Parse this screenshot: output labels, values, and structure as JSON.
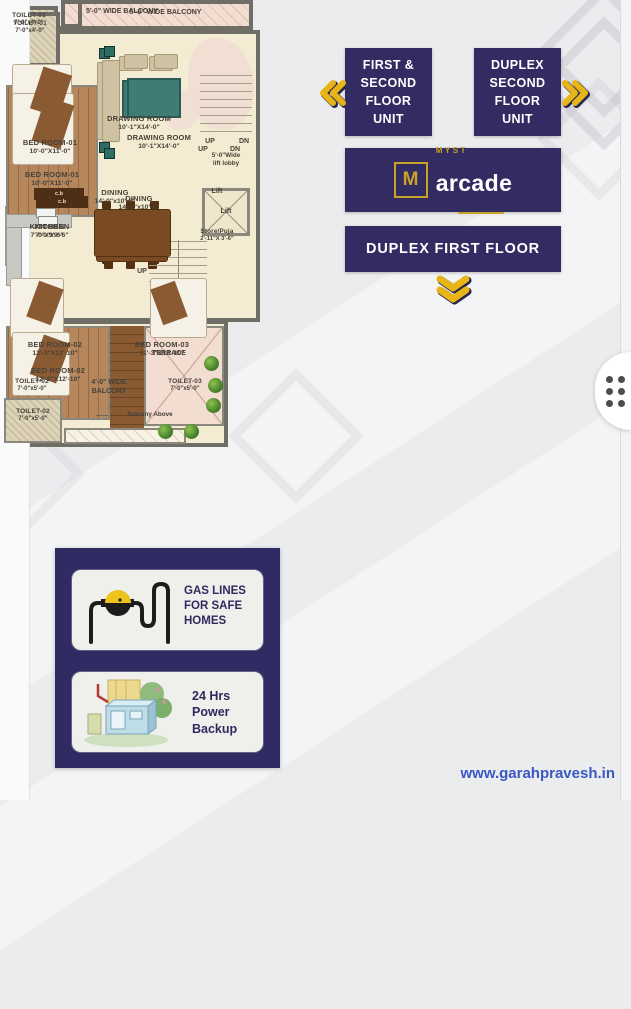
{
  "page": {
    "watermark": "www.garahpravesh.in"
  },
  "colors": {
    "navy": "#322c63",
    "gold": "#e7b516",
    "floor_cream": "#f4ecd2",
    "balcony_pink": "#f3dcd0",
    "wall_gray": "#6f6d66",
    "watermark_blue": "#3a57c4"
  },
  "icons": {
    "nav_left": "chevrons-left",
    "nav_right": "chevrons-right",
    "nav_down": "chevrons-down",
    "handle": "drag-handle-dots",
    "gas": "gas-meter",
    "power": "generator"
  },
  "nav": {
    "first_second": "FIRST &\nSECOND\nFLOOR\nUNIT",
    "duplex_second": "DUPLEX\nSECOND\nFLOOR\nUNIT",
    "duplex_first": "DUPLEX FIRST FLOOR"
  },
  "logo": {
    "monogram": "M",
    "name_top": "MYST",
    "name_main": "arcade"
  },
  "amenities": {
    "gas": "GAS LINES FOR SAFE HOMES",
    "power": "24 Hrs Power Backup"
  },
  "plan1": {
    "balcony_top": "5'-0\" WIDE BALCONY",
    "toilet1": {
      "name": "TOILET-01",
      "dim": "7'-0\"x4'-0\""
    },
    "bedroom1": {
      "name": "BED ROOM-01",
      "dim": "10'-0\"X11'-0\""
    },
    "drawing": {
      "name": "DRAWING ROOM",
      "dim": "10'-1\"X14'-0\""
    },
    "dining": {
      "name": "DINING",
      "dim": "14'-0\"x10'-6\""
    },
    "kitchen": {
      "name": "KITCHEN",
      "dim": "7'-0\"x9'-6\""
    },
    "stairs_up": "UP",
    "stairs_dn": "DN",
    "lift": "Lift",
    "store": {
      "name": "Store/Puja",
      "dim": "2'-11\"X 3'-6\""
    },
    "cb": "c.b",
    "bedroom2": {
      "name": "BED ROOM-02",
      "dim": "12'-3\"X12'-10\""
    },
    "bedroom3": {
      "name": "BED ROOM-03",
      "dim": "11'-3\"X12'-10\""
    },
    "toilet2": {
      "name": "TOILET-02",
      "dim": "7'-0\"x5'-0\""
    },
    "toilet3": {
      "name": "TOILET-03",
      "dim": "7'-0\"x5'-0\""
    },
    "balcony_bottom": "4'-0\" WIDE\nBALCONY"
  },
  "plan2": {
    "balcony_top": "5'-0\" WIDE BALCONY",
    "toilet1": {
      "name": "TOILET-01",
      "dim": "7'-0\"x4'-0\""
    },
    "bedroom1": {
      "name": "BED ROOM-01",
      "dim": "10'-0\"X11'-0\""
    },
    "drawing": {
      "name": "DRAWING ROOM",
      "dim": "10'-1\"X14'-0\""
    },
    "stairs_up": "UP",
    "stairs_dn": "DN",
    "lift_lobby": "5'-0\"Wide\nlift lobby",
    "dining": {
      "name": "DINING",
      "dim": "14'-0\"x10'-6\""
    },
    "kitchen": {
      "name": "KITCHEN",
      "dim": "7'-0\"x9'-6\""
    },
    "lift": "Lift",
    "stairs_up2": "UP",
    "cb": "c.b",
    "bedroom2": {
      "name": "BED ROOM-02",
      "dim": "12'-3\"X12'-10\""
    },
    "toilet2": {
      "name": "TOILET-02",
      "dim": "7'-0\"x5'-0\""
    },
    "terrace": "TERRACE",
    "balcony_above": "Balcony Above"
  }
}
